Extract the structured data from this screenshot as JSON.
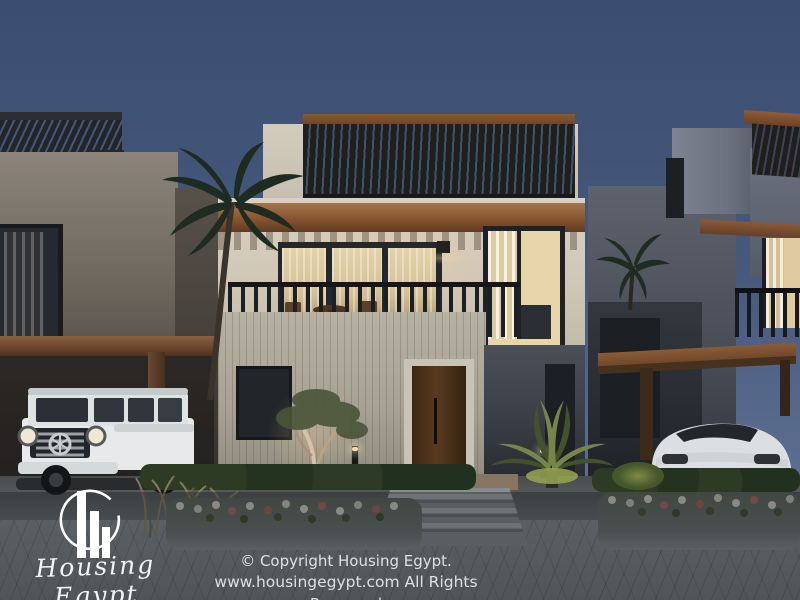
{
  "watermark": {
    "logo_text": "Housing Egypt",
    "copyright_line1": "© Copyright Housing Egypt.",
    "copyright_line2": "www.housingegypt.com All Rights Reserved"
  },
  "scene": {
    "type": "3d-architectural-render",
    "time_of_day": "dusk",
    "subject": "Row of modern beige villas with rooftop wood pergolas, lit balcony and windows, palm trees, landscaped planters, and two white SUVs parked under wooden carports",
    "colors": {
      "sky_top": "#3a4e72",
      "sky_horizon": "#5c6e90",
      "wall_cream": "#d4ccbe",
      "wall_slat": "#b0ab9d",
      "wall_shadow_gray": "#4b5058",
      "wood_brown": "#8a5a36",
      "window_glow": "#e7d6ac",
      "greenery_dark": "#243021",
      "greenery_bright": "#76864a",
      "pavement_gray": "#82878c",
      "overlay": "rgba(26,30,35,0.42)",
      "text_light": "#eceff1"
    }
  }
}
